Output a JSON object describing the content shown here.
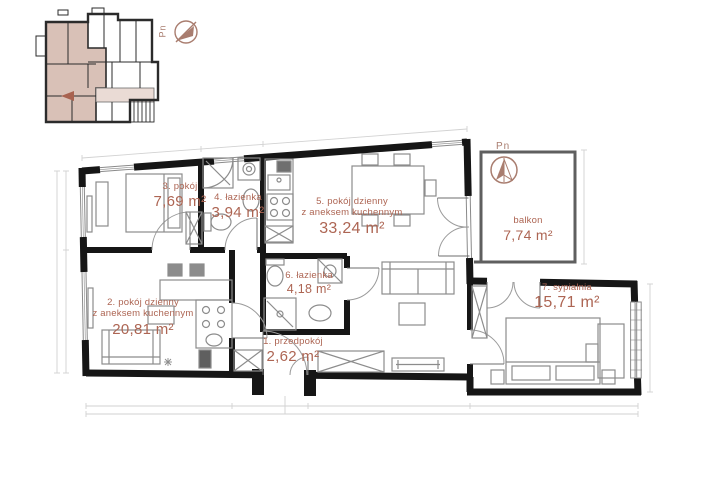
{
  "colors": {
    "accent": "#ad6553",
    "wall": "#161616",
    "furniture": "#8c8c8c",
    "apartment_fill": "#d9c1b7",
    "corridor_fill": "#eadbd5",
    "compass": "#a97d6f",
    "dimension": "#d2d2d2"
  },
  "compass": {
    "label": "Pn"
  },
  "rooms": {
    "r1": {
      "name": "1. przedpokój",
      "area": "2,62 m²"
    },
    "r2": {
      "name": "2. pokój dzienny\nz aneksem kuchennym",
      "area": "20,81 m²"
    },
    "r3": {
      "name": "3. pokój",
      "area": "7,69 m²"
    },
    "r4": {
      "name": "4. łazienka",
      "area": "3,94 m²"
    },
    "r5": {
      "name": "5. pokój dzienny\nz aneksem kuchennym",
      "area": "33,24 m²"
    },
    "r6": {
      "name": "6. łazienka",
      "area": "4,18 m²"
    },
    "r7": {
      "name": "7. sypialnia",
      "area": "15,71 m²"
    },
    "balkon": {
      "name": "balkon",
      "area": "7,74 m²"
    }
  }
}
